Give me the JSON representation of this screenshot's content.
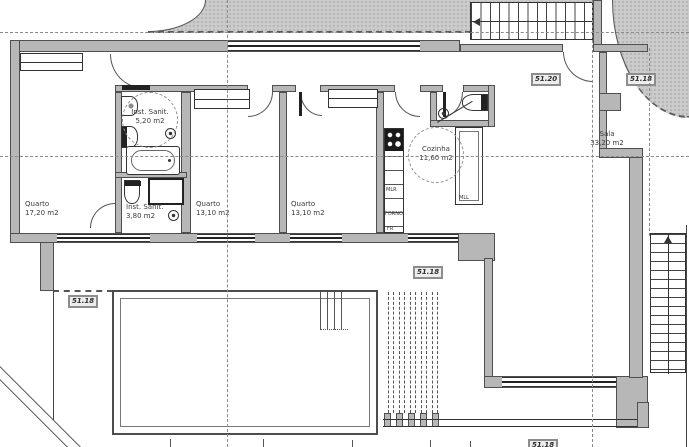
{
  "rooms": {
    "quarto1": {
      "name": "Quarto",
      "area": "17,20 m2"
    },
    "sanit1": {
      "name": "Inst. Sanit.",
      "area": "5,20 m2"
    },
    "sanit2": {
      "name": "Inst. Sanit.",
      "area": "3,80 m2"
    },
    "quarto2": {
      "name": "Quarto",
      "area": "13,10 m2"
    },
    "quarto3": {
      "name": "Quarto",
      "area": "13,10 m2"
    },
    "cozinha": {
      "name": "Cozinha",
      "area": "11,60 m2"
    },
    "sala": {
      "name": "Sala",
      "area": "33,20 m2"
    }
  },
  "levels": {
    "sala_upper": "51.20",
    "east_terrace": "51.18",
    "west_terrace": "51.18",
    "patio": "51.18",
    "lower_walk": "51.18"
  },
  "appliances": {
    "washer": "MLR",
    "oven": "FORNO",
    "fridge": "FR",
    "dishwasher": "MLL"
  },
  "colors": {
    "wall_fill": "#b7b7b7",
    "wall_edge": "#4f4f4f",
    "terrain": "#cbcbcb",
    "line": "#333333"
  }
}
